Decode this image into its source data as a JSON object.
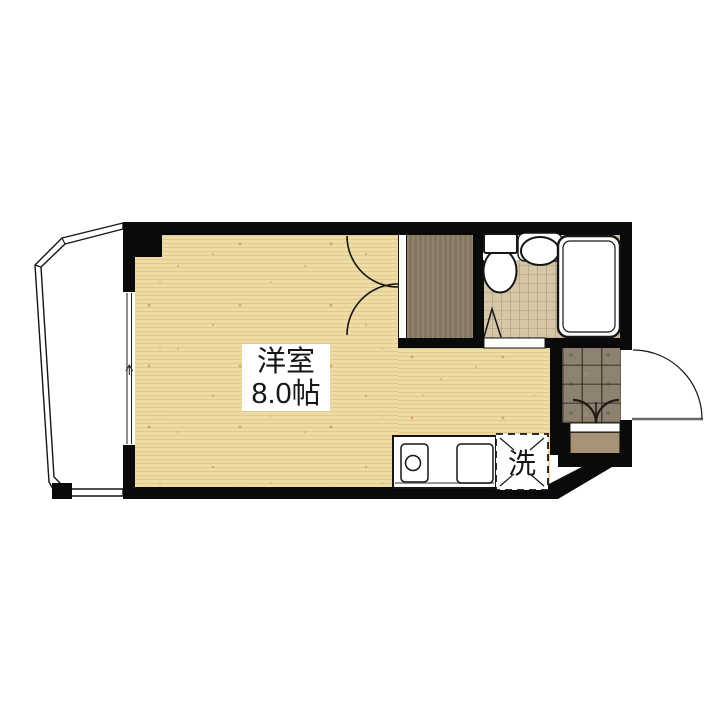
{
  "plan": {
    "kind": "apartment-floor-plan",
    "rooms": {
      "main": {
        "name": "洋室",
        "area": "8.0帖"
      },
      "laundry_label": "洗"
    },
    "fixture_icons": [
      "toilet-icon",
      "sink-icon",
      "bathtub-icon",
      "stove-burner-icon",
      "kitchen-sink-icon",
      "double-door-icon",
      "folding-door-icon",
      "entrance-door-swing-icon",
      "window-icon",
      "balcony-railing-icon"
    ],
    "colors": {
      "wall": "#0a0a0a",
      "wood": "#efdca4",
      "bath": "#d5c6a8",
      "tile": "#8d8172",
      "closet": "#8a7d66",
      "step": "#a69276",
      "line": "#151515"
    }
  }
}
